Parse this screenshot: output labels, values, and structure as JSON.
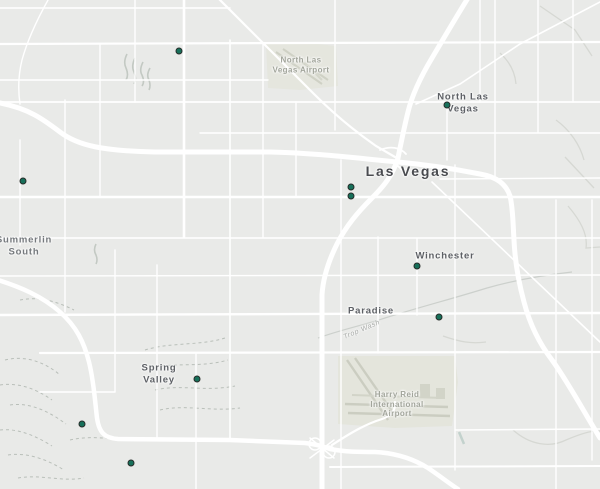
{
  "map": {
    "region": "Las Vegas valley street map",
    "background_color": "#e9eae8",
    "road_color": "#ffffff",
    "airport_fill": "#e5e6de",
    "marker_fill": "#17705a",
    "marker_outline": "#262c29"
  },
  "labels": {
    "city": {
      "text": "Las Vegas"
    },
    "north_las_vegas": {
      "line1": "North Las",
      "line2": "Vegas"
    },
    "summerlin_south": {
      "line1": "Summerlin",
      "line2": "South"
    },
    "winchester": {
      "text": "Winchester"
    },
    "paradise": {
      "text": "Paradise"
    },
    "spring_valley": {
      "line1": "Spring",
      "line2": "Valley"
    },
    "north_las_vegas_airport": {
      "line1": "North Las",
      "line2": "Vegas Airport"
    },
    "harry_reid_airport": {
      "line1": "Harry Reid",
      "line2": "International",
      "line3": "Airport"
    },
    "trop_wash": {
      "text": "Trop Wash"
    }
  },
  "markers": {
    "count": 10,
    "points": [
      [
        179,
        51
      ],
      [
        447,
        105
      ],
      [
        23,
        181
      ],
      [
        351,
        187
      ],
      [
        351,
        196
      ],
      [
        417,
        266
      ],
      [
        439,
        317
      ],
      [
        197,
        379
      ],
      [
        82,
        424
      ],
      [
        131,
        463
      ]
    ]
  }
}
